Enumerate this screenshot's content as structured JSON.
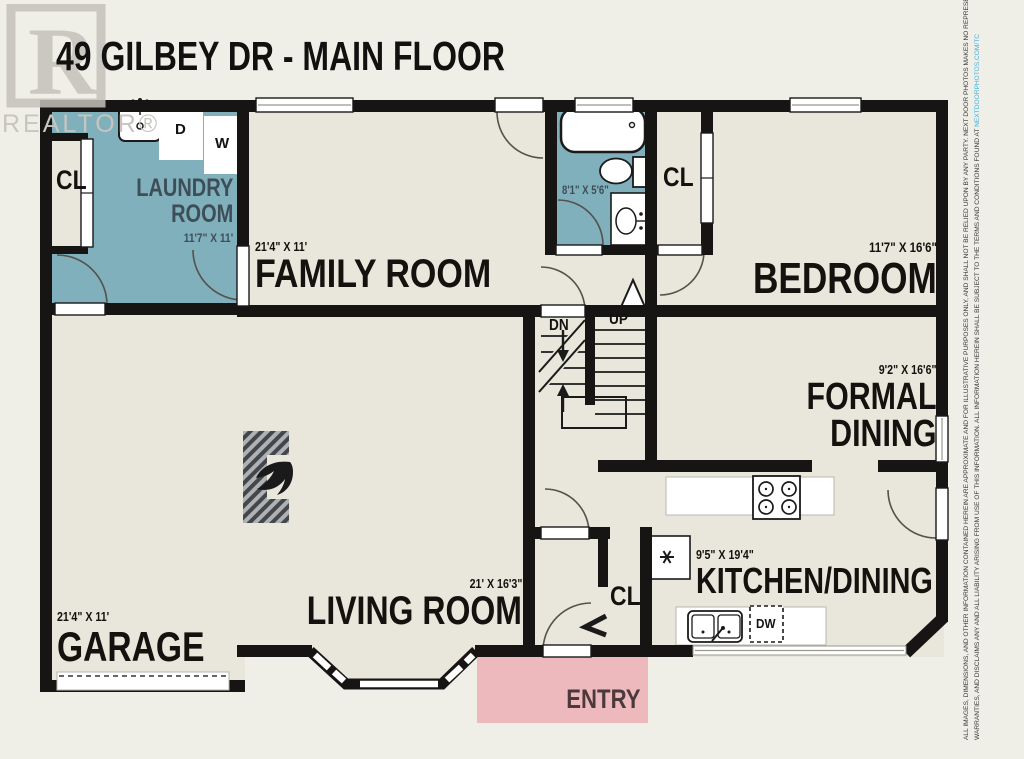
{
  "title": "49 GILBEY DR - MAIN FLOOR",
  "watermark": {
    "letter": "R",
    "label": "REALTOR®"
  },
  "rooms": {
    "laundry": {
      "name": "LAUNDRY\nROOM",
      "dims": "11'7\" X 11'"
    },
    "family": {
      "name": "FAMILY ROOM",
      "dims": "21'4\" X 11'"
    },
    "bathroom": {
      "dims": "8'1\" X 5'6\""
    },
    "bedroom": {
      "name": "BEDROOM",
      "dims": "11'7\" X 16'6\""
    },
    "formal_dining": {
      "name": "FORMAL\nDINING",
      "dims": "9'2\" X 16'6\""
    },
    "kitchen": {
      "name": "KITCHEN/DINING",
      "dims": "9'5\" X 19'4\""
    },
    "living": {
      "name": "LIVING ROOM",
      "dims": "21' X 16'3\""
    },
    "garage": {
      "name": "GARAGE",
      "dims": "21'4\" X 11'"
    },
    "entry": {
      "name": "ENTRY"
    }
  },
  "closets": {
    "laundry": "CL",
    "bathroom": "CL",
    "entry": "CL"
  },
  "stairs": {
    "down": "DN",
    "up": "UP"
  },
  "appliances": {
    "washer": "W",
    "dryer": "D",
    "dishwasher": "DW"
  },
  "disclaimer": {
    "line1": "ALL IMAGES, DIMENSIONS, AND OTHER INFORMATION CONTAINED HEREIN ARE APPROXIMATE AND FOR ILLUSTRATIVE PURPOSES ONLY, AND SHALL NOT BE RELIED UPON BY ANY PARTY. NEXT DOOR PHOTOS MAKES NO REPRESENTATIONS OR",
    "line2": "WARRANTIES, AND DISCLAIMS ANY AND ALL LIABILITY ARISING FROM USE OF THIS INFORMATION. ALL INFORMATION HEREIN SHALL BE SUBJECT TO THE TERMS AND CONDITIONS FOUND AT ",
    "link": "NEXTDOORPHOTOS.COM/TC"
  },
  "colors": {
    "wall": "#171513",
    "floor": "#e9e7db",
    "wet_room": "#7fb0bb",
    "entry": "#edb9bd",
    "link": "#3fb3de"
  }
}
